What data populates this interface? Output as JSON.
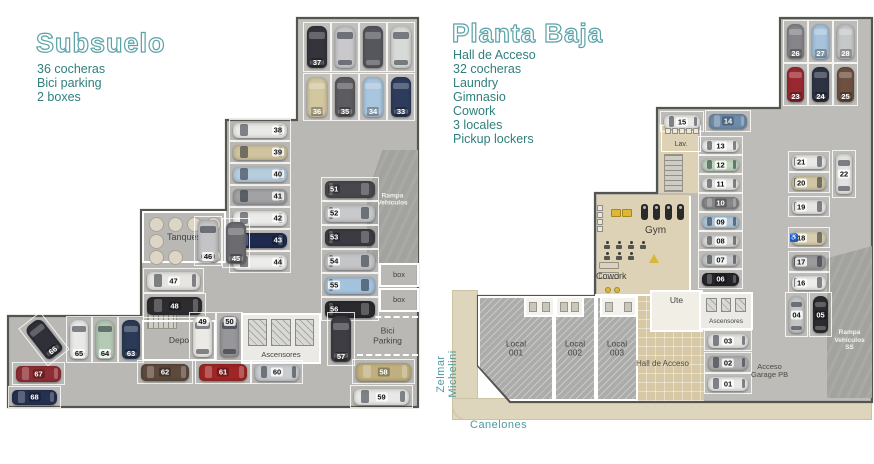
{
  "colors": {
    "accent": "#4d9a9e",
    "title_stroke": "#5ba3a8",
    "list_text": "#2f7f7c",
    "floor_sub": "#b9b8b4",
    "floor_pb": "#bdbcb8",
    "tan": "#ddd2b6",
    "hall": "#d7c9a5",
    "walk": "#ded5bd",
    "hatch": "#acacaa",
    "ramp": "#a2a29e",
    "outline": "#55554f",
    "label": "#44443f"
  },
  "icons": {
    "accessible": "♿"
  },
  "left_panel": {
    "title": "Subsuelo",
    "features": [
      "36 cocheras",
      "Bici parking",
      "2 boxes"
    ]
  },
  "right_panel": {
    "title": "Planta Baja",
    "features": [
      "Hall de Acceso",
      "32 cocheras",
      "Laundry",
      "Gimnasio",
      "Cowork",
      "3 locales",
      "Pickup lockers"
    ]
  },
  "streets": {
    "vertical": "Zelmar Michelini",
    "horizontal": "Canelones"
  },
  "subsuelo": {
    "outline": "297,18 418,18 418,407 8,407 8,316 141,316 141,210 226,210 226,120 297,120",
    "zones": [
      {
        "x": 298,
        "y": 19,
        "w": 119,
        "h": 101,
        "k": "lite"
      }
    ],
    "walls": [],
    "rooms": [
      {
        "t": "ramp",
        "x": 367,
        "y": 150,
        "w": 51,
        "h": 113,
        "label": "Rampa\nVehículos",
        "clip": "polygon(30% 0,100% 0,100% 100%,0 100%,0 40%)",
        "ly": 44
      },
      {
        "t": "tanques",
        "x": 142,
        "y": 211,
        "w": 84,
        "h": 52,
        "label": "Tanques",
        "fs": 9
      },
      {
        "t": "stair",
        "x": 147,
        "y": 312,
        "w": 30,
        "h": 17
      },
      {
        "t": "room",
        "x": 142,
        "y": 320,
        "w": 74,
        "h": 41,
        "label": "Depo",
        "fs": 8.5
      },
      {
        "t": "lift",
        "x": 241,
        "y": 313,
        "w": 80,
        "h": 51,
        "label": "Ascensores",
        "fs": 7.5
      },
      {
        "t": "bici",
        "x": 357,
        "y": 316,
        "w": 61,
        "h": 40,
        "label": "Bici\nParking",
        "fs": 8.5
      },
      {
        "t": "box",
        "x": 379,
        "y": 263,
        "w": 40,
        "h": 24,
        "label": "box",
        "fs": 7.5
      },
      {
        "t": "box",
        "x": 379,
        "y": 288,
        "w": 40,
        "h": 24,
        "label": "box",
        "fs": 7.5
      }
    ],
    "cars": [
      {
        "n": "37",
        "x": 303,
        "y": 22,
        "w": 28,
        "h": 50,
        "o": "v",
        "c": "#34343c",
        "dk": 1
      },
      {
        "n": "",
        "x": 331,
        "y": 22,
        "w": 28,
        "h": 50,
        "o": "v",
        "c": "#c9c9cc"
      },
      {
        "n": "",
        "x": 359,
        "y": 22,
        "w": 28,
        "h": 50,
        "o": "v",
        "c": "#56575d",
        "dk": 1
      },
      {
        "n": "",
        "x": 387,
        "y": 22,
        "w": 28,
        "h": 50,
        "o": "v",
        "c": "#d8dad8"
      },
      {
        "n": "36",
        "x": 303,
        "y": 73,
        "w": 28,
        "h": 48,
        "o": "v",
        "c": "#d3c7a0",
        "dk": 1
      },
      {
        "n": "35",
        "x": 331,
        "y": 73,
        "w": 28,
        "h": 48,
        "o": "v",
        "c": "#5c5c60",
        "dk": 1
      },
      {
        "n": "34",
        "x": 359,
        "y": 73,
        "w": 28,
        "h": 48,
        "o": "v",
        "c": "#a9c6de",
        "dk": 1
      },
      {
        "n": "33",
        "x": 387,
        "y": 73,
        "w": 28,
        "h": 48,
        "o": "v",
        "c": "#2d3c5c",
        "dk": 1
      },
      {
        "n": "38",
        "x": 229,
        "y": 119,
        "w": 62,
        "h": 22,
        "o": "h",
        "np": "r",
        "c": "#e9e9e7"
      },
      {
        "n": "39",
        "x": 229,
        "y": 141,
        "w": 62,
        "h": 22,
        "o": "h",
        "np": "r",
        "c": "#d0c49e"
      },
      {
        "n": "40",
        "x": 229,
        "y": 163,
        "w": 62,
        "h": 22,
        "o": "h",
        "np": "r",
        "c": "#b6cdde"
      },
      {
        "n": "41",
        "x": 229,
        "y": 185,
        "w": 62,
        "h": 22,
        "o": "h",
        "np": "r",
        "c": "#a2a2a4"
      },
      {
        "n": "42",
        "x": 229,
        "y": 207,
        "w": 62,
        "h": 22,
        "o": "h",
        "np": "r",
        "c": "#ebebe9"
      },
      {
        "n": "43",
        "x": 229,
        "y": 229,
        "w": 62,
        "h": 22,
        "o": "h",
        "np": "r",
        "c": "#1f2b4e",
        "dk": 1
      },
      {
        "n": "44",
        "x": 229,
        "y": 251,
        "w": 62,
        "h": 22,
        "o": "h",
        "np": "r",
        "c": "#ececea"
      },
      {
        "n": "46",
        "x": 194,
        "y": 216,
        "w": 28,
        "h": 50,
        "o": "v",
        "van": 1,
        "c": "#c4c4c6"
      },
      {
        "n": "45",
        "x": 222,
        "y": 218,
        "w": 28,
        "h": 50,
        "o": "v",
        "c": "#6b6b70",
        "dk": 1
      },
      {
        "n": "47",
        "x": 143,
        "y": 268,
        "w": 61,
        "h": 25,
        "o": "h",
        "c": "#e7e5e1"
      },
      {
        "n": "48",
        "x": 143,
        "y": 293,
        "w": 63,
        "h": 25,
        "o": "h",
        "c": "#2d2d30",
        "dk": 1
      },
      {
        "n": "51",
        "x": 321,
        "y": 177,
        "w": 58,
        "h": 24,
        "o": "h",
        "np": "l",
        "c": "#47474d",
        "dk": 1
      },
      {
        "n": "52",
        "x": 321,
        "y": 201,
        "w": 58,
        "h": 24,
        "o": "h",
        "np": "l",
        "c": "#c7c9cb"
      },
      {
        "n": "53",
        "x": 321,
        "y": 225,
        "w": 58,
        "h": 24,
        "o": "h",
        "np": "l",
        "c": "#3b3b41",
        "dk": 1
      },
      {
        "n": "54",
        "x": 321,
        "y": 249,
        "w": 58,
        "h": 24,
        "o": "h",
        "np": "l",
        "c": "#c3c5c7"
      },
      {
        "n": "55",
        "x": 321,
        "y": 273,
        "w": 58,
        "h": 24,
        "o": "h",
        "np": "l",
        "c": "#a4c4de"
      },
      {
        "n": "56",
        "x": 321,
        "y": 297,
        "w": 58,
        "h": 24,
        "o": "h",
        "np": "l",
        "c": "#2a2a2e",
        "dk": 1
      },
      {
        "n": "57",
        "x": 327,
        "y": 312,
        "w": 28,
        "h": 54,
        "o": "v",
        "c": "#3d3d43",
        "dk": 1
      },
      {
        "n": "58",
        "x": 352,
        "y": 359,
        "w": 63,
        "h": 25,
        "o": "h",
        "c": "#c0b080",
        "dk": 1
      },
      {
        "n": "59",
        "x": 350,
        "y": 385,
        "w": 63,
        "h": 23,
        "o": "h",
        "c": "#e8e8e6"
      },
      {
        "n": "66",
        "x": 30,
        "y": 315,
        "w": 28,
        "h": 48,
        "o": "v",
        "rot": -38,
        "c": "#2f3038",
        "dk": 1
      },
      {
        "n": "65",
        "x": 66,
        "y": 316,
        "w": 26,
        "h": 47,
        "o": "v",
        "c": "#e9e9e7"
      },
      {
        "n": "64",
        "x": 92,
        "y": 316,
        "w": 26,
        "h": 47,
        "o": "v",
        "c": "#b5cab5"
      },
      {
        "n": "63",
        "x": 118,
        "y": 316,
        "w": 26,
        "h": 47,
        "o": "v",
        "c": "#2b3a56",
        "dk": 1
      },
      {
        "n": "49",
        "x": 189,
        "y": 312,
        "w": 27,
        "h": 49,
        "o": "v",
        "np": "t",
        "c": "#eceae6"
      },
      {
        "n": "50",
        "x": 216,
        "y": 312,
        "w": 27,
        "h": 49,
        "o": "v",
        "np": "t",
        "c": "#97979a"
      },
      {
        "n": "67",
        "x": 12,
        "y": 362,
        "w": 53,
        "h": 23,
        "o": "h",
        "c": "#8e2d33",
        "dk": 1
      },
      {
        "n": "68",
        "x": 8,
        "y": 386,
        "w": 53,
        "h": 22,
        "o": "h",
        "c": "#253150",
        "dk": 1
      },
      {
        "n": "62",
        "x": 137,
        "y": 360,
        "w": 56,
        "h": 24,
        "o": "h",
        "c": "#5d4a3c",
        "dk": 1
      },
      {
        "n": "61",
        "x": 195,
        "y": 360,
        "w": 56,
        "h": 24,
        "o": "h",
        "c": "#9e2626",
        "dk": 1
      },
      {
        "n": "60",
        "x": 251,
        "y": 360,
        "w": 52,
        "h": 24,
        "o": "h",
        "c": "#c9cdcf"
      }
    ],
    "icons": [],
    "labels": []
  },
  "planta_baja": {
    "outline": "780,18 872,18 872,402 510,402 478,366 478,296 595,296 595,193 657,193 657,108 780,108",
    "walk": [
      {
        "x": 452,
        "y": 290,
        "w": 26,
        "h": 130
      },
      {
        "x": 452,
        "y": 398,
        "w": 420,
        "h": 22,
        "r": "0 0 0 14px"
      }
    ],
    "zones": [
      {
        "x": 659,
        "y": 124,
        "w": 39,
        "h": 69,
        "k": "tan"
      },
      {
        "x": 597,
        "y": 195,
        "w": 93,
        "h": 101,
        "k": "tan"
      },
      {
        "x": 637,
        "y": 296,
        "w": 67,
        "h": 105,
        "k": "hall"
      }
    ],
    "walls": [
      {
        "x": 689,
        "y": 196,
        "w": 2,
        "h": 99
      },
      {
        "x": 595,
        "y": 294,
        "w": 113,
        "h": 2
      }
    ],
    "rooms": [
      {
        "t": "ramp",
        "x": 827,
        "y": 246,
        "w": 45,
        "h": 152,
        "label": "Rampa\nVehículos\nSS",
        "clip": "polygon(0 8%,100% 0,100% 100%,0 100%)",
        "ly": 62
      },
      {
        "t": "local",
        "x": 478,
        "y": 296,
        "w": 76,
        "h": 105,
        "label": "Local\n001",
        "clip": "polygon(0 0,100% 0,100% 100%,43% 100%,0 66%)",
        "fs": 8.5
      },
      {
        "t": "local",
        "x": 554,
        "y": 296,
        "w": 42,
        "h": 105,
        "label": "Local\n002",
        "fs": 8.5
      },
      {
        "t": "local",
        "x": 596,
        "y": 296,
        "w": 42,
        "h": 105,
        "label": "Local\n003",
        "fs": 8.5
      },
      {
        "t": "wc",
        "x": 524,
        "y": 296,
        "w": 31,
        "h": 21
      },
      {
        "t": "wc",
        "x": 555,
        "y": 296,
        "w": 29,
        "h": 21
      },
      {
        "t": "wc",
        "x": 600,
        "y": 296,
        "w": 37,
        "h": 21
      },
      {
        "t": "room",
        "x": 650,
        "y": 290,
        "w": 53,
        "h": 42,
        "label": "Ute",
        "fs": 8.5,
        "bg": "#f1eee6",
        "lp": "t"
      },
      {
        "t": "lift",
        "x": 699,
        "y": 292,
        "w": 54,
        "h": 38,
        "label": "Ascensores",
        "fs": 6.5
      },
      {
        "t": "outline-room",
        "x": 661,
        "y": 125,
        "w": 40,
        "h": 27,
        "label": "Lav.",
        "fs": 7,
        "lp": "b"
      },
      {
        "t": "stair",
        "x": 664,
        "y": 154,
        "w": 19,
        "h": 38,
        "vert": 1
      }
    ],
    "cars": [
      {
        "n": "26",
        "x": 783,
        "y": 20,
        "w": 25,
        "h": 43,
        "o": "v",
        "c": "#85858a",
        "dk": 1
      },
      {
        "n": "27",
        "x": 808,
        "y": 20,
        "w": 25,
        "h": 43,
        "o": "v",
        "c": "#a7c3db",
        "dk": 1
      },
      {
        "n": "28",
        "x": 833,
        "y": 20,
        "w": 25,
        "h": 43,
        "o": "v",
        "c": "#c5c7c9",
        "dk": 1
      },
      {
        "n": "23",
        "x": 783,
        "y": 63,
        "w": 25,
        "h": 43,
        "o": "v",
        "c": "#992830",
        "dk": 1
      },
      {
        "n": "24",
        "x": 808,
        "y": 63,
        "w": 25,
        "h": 43,
        "o": "v",
        "c": "#2d3343",
        "dk": 1
      },
      {
        "n": "25",
        "x": 833,
        "y": 63,
        "w": 25,
        "h": 43,
        "o": "v",
        "c": "#6d5040",
        "dk": 1
      },
      {
        "n": "22",
        "x": 832,
        "y": 150,
        "w": 24,
        "h": 48,
        "o": "v",
        "van": 1,
        "np": "c",
        "c": "#e3e3e1"
      },
      {
        "n": "21",
        "x": 788,
        "y": 151,
        "w": 42,
        "h": 21,
        "o": "h",
        "np": "l",
        "c": "#e9e9e7"
      },
      {
        "n": "20",
        "x": 788,
        "y": 172,
        "w": 42,
        "h": 21,
        "o": "h",
        "np": "l",
        "c": "#d1c7a3"
      },
      {
        "n": "19",
        "x": 788,
        "y": 196,
        "w": 42,
        "h": 21,
        "o": "h",
        "np": "l",
        "c": "#e6e6e4"
      },
      {
        "n": "18",
        "x": 788,
        "y": 227,
        "w": 42,
        "h": 21,
        "o": "h",
        "np": "l",
        "c": "#d7cead",
        "acc": 1
      },
      {
        "n": "17",
        "x": 788,
        "y": 251,
        "w": 42,
        "h": 21,
        "o": "h",
        "np": "l",
        "c": "#9b9b9d"
      },
      {
        "n": "16",
        "x": 788,
        "y": 272,
        "w": 42,
        "h": 21,
        "o": "h",
        "np": "l",
        "c": "#ededeb"
      },
      {
        "n": "04",
        "x": 785,
        "y": 292,
        "w": 23,
        "h": 45,
        "o": "v",
        "np": "c",
        "c": "#c3c5c7"
      },
      {
        "n": "05",
        "x": 809,
        "y": 292,
        "w": 23,
        "h": 45,
        "o": "v",
        "np": "c",
        "c": "#2c2c30",
        "dk": 1
      },
      {
        "n": "15",
        "x": 660,
        "y": 111,
        "w": 44,
        "h": 21,
        "o": "h",
        "np": "c",
        "c": "#e9e9e7"
      },
      {
        "n": "14",
        "x": 705,
        "y": 110,
        "w": 46,
        "h": 22,
        "o": "h",
        "np": "c",
        "c": "#6f8dab",
        "dk": 1
      },
      {
        "n": "13",
        "x": 698,
        "y": 136,
        "w": 45,
        "h": 19,
        "o": "h",
        "np": "c",
        "c": "#ededeb"
      },
      {
        "n": "12",
        "x": 698,
        "y": 155,
        "w": 45,
        "h": 19,
        "o": "h",
        "np": "c",
        "c": "#c0d6c0"
      },
      {
        "n": "11",
        "x": 698,
        "y": 174,
        "w": 45,
        "h": 19,
        "o": "h",
        "np": "c",
        "c": "#e6e6e4"
      },
      {
        "n": "10",
        "x": 698,
        "y": 193,
        "w": 45,
        "h": 19,
        "o": "h",
        "np": "c",
        "c": "#87878a",
        "dk": 1
      },
      {
        "n": "09",
        "x": 698,
        "y": 212,
        "w": 45,
        "h": 19,
        "o": "h",
        "np": "c",
        "c": "#aec6d8"
      },
      {
        "n": "08",
        "x": 698,
        "y": 231,
        "w": 45,
        "h": 19,
        "o": "h",
        "np": "c",
        "c": "#d7d7d5"
      },
      {
        "n": "07",
        "x": 698,
        "y": 250,
        "w": 45,
        "h": 19,
        "o": "h",
        "np": "c",
        "c": "#c5c7c9"
      },
      {
        "n": "06",
        "x": 698,
        "y": 269,
        "w": 45,
        "h": 20,
        "o": "h",
        "np": "c",
        "c": "#25252a",
        "dk": 1
      },
      {
        "n": "03",
        "x": 704,
        "y": 330,
        "w": 48,
        "h": 21,
        "o": "h",
        "np": "c",
        "c": "#e5e5e3"
      },
      {
        "n": "02",
        "x": 704,
        "y": 352,
        "w": 48,
        "h": 21,
        "o": "h",
        "np": "c",
        "c": "#b3b3b5"
      },
      {
        "n": "01",
        "x": 704,
        "y": 373,
        "w": 48,
        "h": 21,
        "o": "h",
        "np": "c",
        "c": "#e9e9e7"
      }
    ],
    "icons": [
      {
        "t": "sqrow",
        "x": 665,
        "y": 128,
        "n": 5,
        "s": 6,
        "g": 1
      },
      {
        "t": "sqcol",
        "x": 597,
        "y": 205,
        "n": 4,
        "s": 6,
        "g": 1
      },
      {
        "t": "tread",
        "x": 641,
        "y": 204
      },
      {
        "t": "tread",
        "x": 653,
        "y": 204
      },
      {
        "t": "tread",
        "x": 665,
        "y": 204
      },
      {
        "t": "tread",
        "x": 677,
        "y": 204
      },
      {
        "t": "rect",
        "x": 611,
        "y": 209,
        "w": 10,
        "h": 8,
        "c": "#dcb838",
        "bc": "#a8861e"
      },
      {
        "t": "rect",
        "x": 622,
        "y": 209,
        "w": 10,
        "h": 8,
        "c": "#dcb838",
        "bc": "#a8861e"
      },
      {
        "t": "fig",
        "x": 603,
        "y": 241
      },
      {
        "t": "fig",
        "x": 615,
        "y": 241
      },
      {
        "t": "fig",
        "x": 627,
        "y": 241
      },
      {
        "t": "fig",
        "x": 639,
        "y": 241
      },
      {
        "t": "fig",
        "x": 603,
        "y": 252
      },
      {
        "t": "fig",
        "x": 615,
        "y": 252
      },
      {
        "t": "fig",
        "x": 627,
        "y": 252
      },
      {
        "t": "cone",
        "x": 649,
        "y": 254
      },
      {
        "t": "rect",
        "x": 599,
        "y": 262,
        "w": 20,
        "h": 7,
        "c": "#d8d2c2",
        "bc": "#97917f"
      },
      {
        "t": "rect",
        "x": 599,
        "y": 272,
        "w": 20,
        "h": 7,
        "c": "#d8d2c2",
        "bc": "#97917f"
      },
      {
        "t": "dot",
        "x": 605,
        "y": 287,
        "c": "#d8b93c"
      },
      {
        "t": "dot",
        "x": 614,
        "y": 287,
        "c": "#d8b93c"
      }
    ],
    "labels": [
      {
        "text": "Gym",
        "x": 645,
        "y": 225,
        "fs": 10,
        "c": "#3d3d38"
      },
      {
        "text": "Cowork",
        "x": 596,
        "y": 271,
        "fs": 9,
        "c": "#3d3d38"
      },
      {
        "text": "Hall de Acceso",
        "x": 636,
        "y": 360,
        "fs": 8,
        "c": "#4f4a40"
      },
      {
        "text": "Acceso\nGarage PB",
        "x": 751,
        "y": 363,
        "fs": 7.5,
        "c": "#4f4a40",
        "ta": "center"
      }
    ]
  }
}
